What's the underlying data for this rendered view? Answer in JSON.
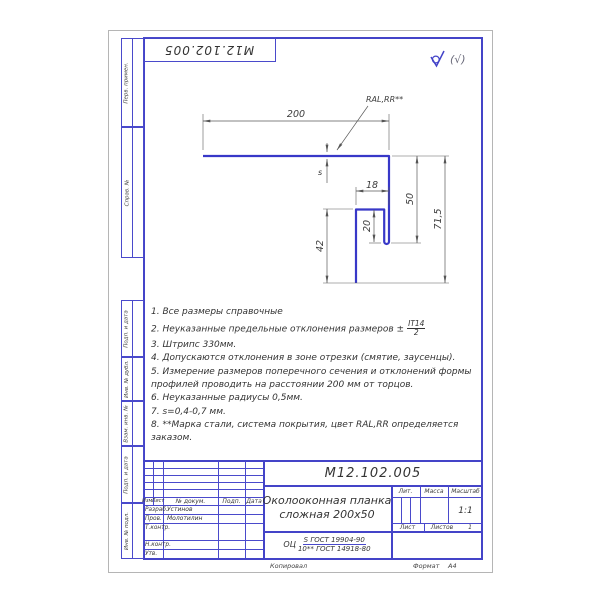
{
  "stamp": {
    "doc_number": "М12.102.005"
  },
  "roughness": {
    "paren": "(√)"
  },
  "margin": {
    "top": [
      {
        "label": "Перв. примен."
      },
      {
        "label": "Справ. №"
      }
    ],
    "bottom": [
      {
        "label": "Подп. и дата"
      },
      {
        "label": "Инв. № дубл."
      },
      {
        "label": "Взам. инв. №"
      },
      {
        "label": "Подп. и дата"
      },
      {
        "label": "Инв. № подл."
      }
    ]
  },
  "drawing": {
    "dims": {
      "width": "200",
      "hook_width": "18",
      "right_height": "50",
      "hook_height": "20",
      "left_height": "42",
      "total_height": "71,5",
      "thickness": "s"
    },
    "coating_label": "RAL,RR**",
    "profile_color": "#3838c8"
  },
  "notes": [
    {
      "n": "1.",
      "t": "Все размеры справочные"
    },
    {
      "n": "2.",
      "t": "Неуказанные предельные отклонения размеров ±",
      "frac_num": "IT14",
      "frac_den": "2"
    },
    {
      "n": "3.",
      "t": "Штрипс 330мм."
    },
    {
      "n": "4.",
      "t": "Допускаются отклонения в зоне отрезки (смятие, заусенцы)."
    },
    {
      "n": "5.",
      "t": "Измерение размеров поперечного сечения и отклонений формы",
      "t2": "профилей проводить на расстоянии 200 мм от торцов."
    },
    {
      "n": "6.",
      "t": "Неуказанные радиусы 0,5мм."
    },
    {
      "n": "7.",
      "t": "s=0,4-0,7 мм."
    },
    {
      "n": "8.",
      "t": "**Марка стали, система покрытия, цвет RAL,RR определяется",
      "t2": "заказом."
    }
  ],
  "title_block": {
    "doc_number": "М12.102.005",
    "title_line1": "Околооконная планка",
    "title_line2": "сложная 200х50",
    "material_prefix": "ОЦ",
    "material_num": "S ГОСТ 19904-90",
    "material_den": "10** ГОСТ 14918-80",
    "cols": {
      "izm": "Изм.",
      "list": "Лист",
      "doc": "№ докум.",
      "podp": "Подп.",
      "data": "Дата"
    },
    "rows": [
      {
        "label": "Разраб.",
        "name": "Устинов"
      },
      {
        "label": "Пров.",
        "name": "Молотилин"
      },
      {
        "label": "Т.контр.",
        "name": ""
      },
      {
        "label": "",
        "name": ""
      },
      {
        "label": "Н.контр.",
        "name": ""
      },
      {
        "label": "Утв.",
        "name": ""
      }
    ],
    "lit_label": "Лит.",
    "mass_label": "Масса",
    "scale_label": "Масштаб",
    "scale": "1:1",
    "sheet_label": "Лист",
    "sheets_label": "Листов",
    "sheets_value": "1",
    "copied": "Копировал",
    "format_label": "Формат",
    "format_value": "А4"
  }
}
